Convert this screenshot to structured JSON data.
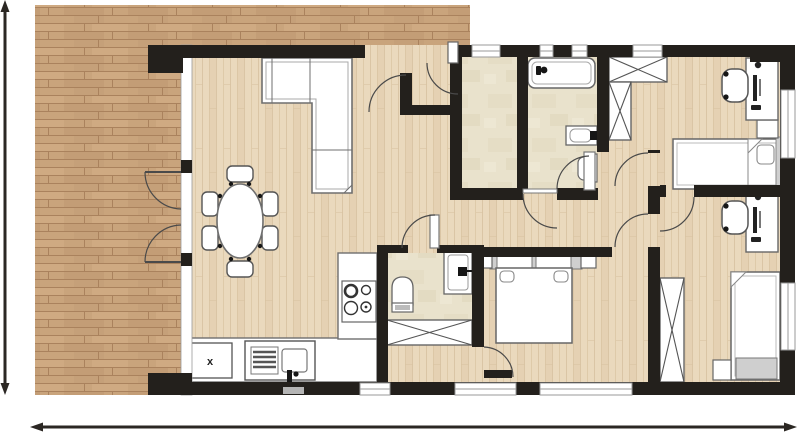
{
  "type": "architectural-floor-plan",
  "labels": {
    "kitchen_cabinet": "x"
  },
  "colors": {
    "deck_base": "#c9a47c",
    "deck_line": "#aa825d",
    "deck_dark": "#bd9671",
    "deck_light": "#d2ad85",
    "floor_base": "#ead9bd",
    "floor_line": "#d9c3a2",
    "floor_streak": "#e1ccab",
    "tile": "#e9e2cc",
    "tile_shadow": "#dbd2b6",
    "wall": "#23201c",
    "outline": "#6f6f6f",
    "outline_light": "#a8a8a8",
    "gray_fill": "#cfcfcf",
    "window_line": "#9a9a9a",
    "black": "#161616",
    "dimension": "#2b2723",
    "white": "#ffffff"
  },
  "rooms": [
    "deck-terrace",
    "entry-porch",
    "living-dining-room",
    "kitchen",
    "shower-room",
    "bathroom",
    "wc",
    "hallway",
    "master-bedroom",
    "bedroom-top-right",
    "bedroom-bottom-right"
  ],
  "furniture": [
    "corner-sofa",
    "dining-table",
    "dining-chairs-6",
    "kitchen-counter-l-shape",
    "kitchen-sink",
    "cooktop-4-burners",
    "base-cabinet-x",
    "bathtub",
    "washbasin-bathroom",
    "toilet-bathroom",
    "toilet-wc",
    "washbasin-wc",
    "wardrobe-x-4",
    "double-bed",
    "single-bed-2",
    "desk-2",
    "desk-chair-2",
    "nightstand-3",
    "french-double-door",
    "dimension-arrows"
  ]
}
